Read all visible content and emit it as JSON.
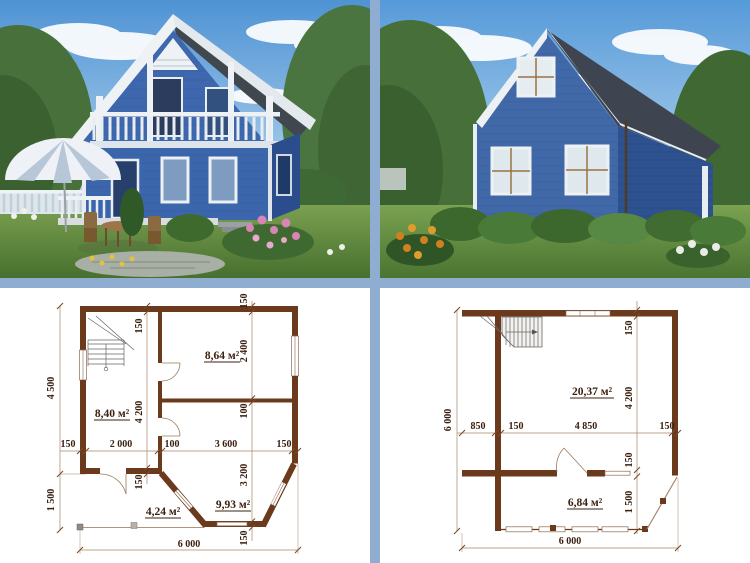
{
  "page": {
    "description": "Collage of a blue country house: two exterior renders (front and rear) above two dimensioned floor plans",
    "colors": {
      "divider": "#8fadd0",
      "plan_wall": "#6b3a1c",
      "plan_text": "#3b2010",
      "house_blue": "#3e67ac",
      "roof_gray": "#40464f",
      "trim_white": "#edf1f4",
      "sky_blue": "#5898d6",
      "grass_green": "#5d8a3e"
    }
  },
  "plan_first_floor": {
    "areas": {
      "room_top_right": "8,64 м²",
      "room_left": "8,40 м²",
      "hall": "4,24 м²",
      "bay_room": "9,93 м²"
    },
    "dims": {
      "left_top": "4 500",
      "left_bottom": "1 500",
      "bottom": "6 000",
      "row": [
        "150",
        "2 000",
        "100",
        "3 600",
        "150"
      ],
      "inner_col": [
        "150",
        "4 200",
        "150"
      ],
      "right_col": [
        "150",
        "2 400",
        "100",
        "3 200",
        "150"
      ]
    }
  },
  "plan_second_floor": {
    "areas": {
      "main_room": "20,37 м²",
      "lower_room": "6,84 м²"
    },
    "dims": {
      "left": "6 000",
      "bottom": "6 000",
      "row": [
        "850",
        "150",
        "4 850",
        "150"
      ],
      "right_col": [
        "150",
        "4 200",
        "150",
        "1 500"
      ]
    }
  }
}
